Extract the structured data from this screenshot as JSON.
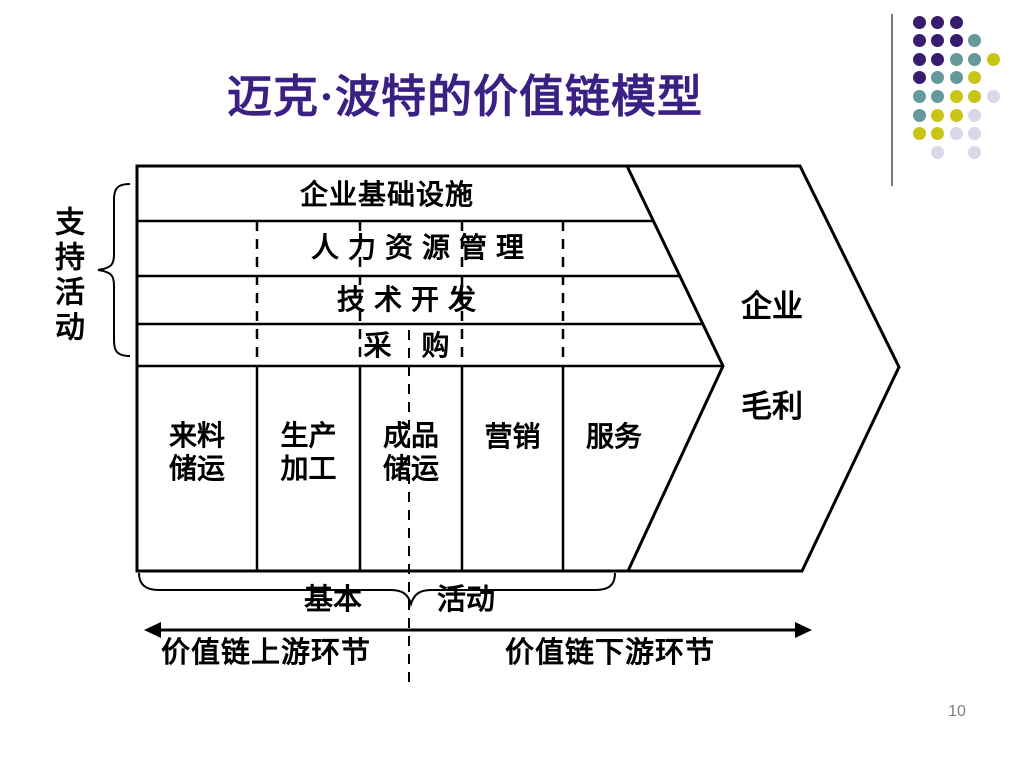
{
  "slide": {
    "title": "迈克·波特的价值链模型",
    "page_number": "10",
    "colors": {
      "title": "#3B2084",
      "line": "#000000",
      "page_number": "#7F7F7F",
      "background": "#FFFFFF"
    }
  },
  "diagram": {
    "support_label": "支持活动",
    "support_rows": [
      "企业基础设施",
      "人 力 资 源 管 理",
      "技 术 开 发",
      "采　购"
    ],
    "primary_cells": [
      "来料\n储运",
      "生产\n加工",
      "成品\n储运",
      "营销",
      "服务"
    ],
    "margin_line1": "企业",
    "margin_line2": "毛利",
    "base_label_left": "基本",
    "base_label_right": "活动",
    "upstream_label": "价值链上游环节",
    "downstream_label": "价值链下游环节"
  },
  "decoration": {
    "pattern": [
      "ppp..",
      "pppt.",
      "pptty",
      "ptty.",
      "ttyyl",
      "tyyl.",
      "yyll.",
      ".l.l."
    ],
    "colors": {
      "p": "#381C6F",
      "t": "#66999A",
      "y": "#C9C516",
      "l": "#D8D8E8"
    },
    "dot_names": {
      "p": "purple-dot",
      "t": "teal-dot",
      "y": "yellow-dot",
      "l": "lavender-dot"
    }
  }
}
